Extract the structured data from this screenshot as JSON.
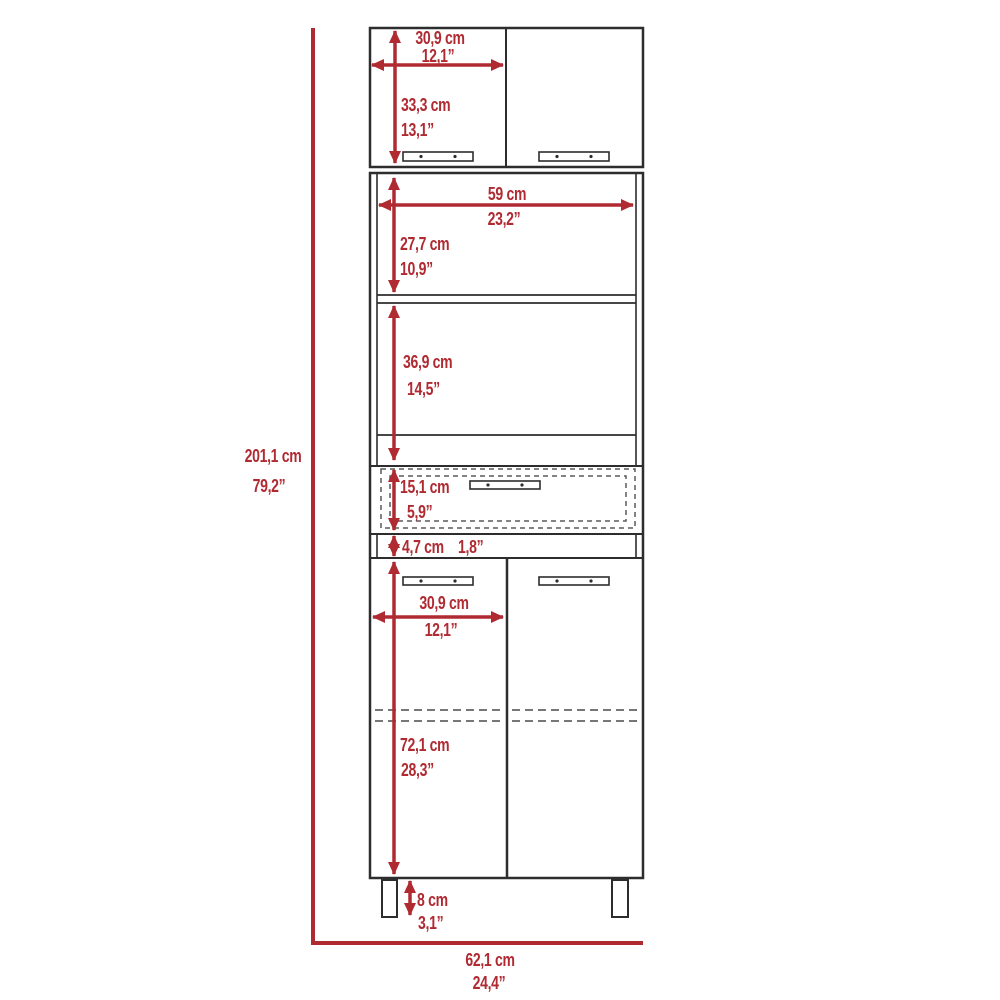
{
  "diagram": {
    "title": "pantry-cabinet-dimension-diagram",
    "colors": {
      "dimension_red": "#b02a32",
      "outline": "#2d2d2d",
      "background": "#ffffff"
    },
    "dims": {
      "overall_height": {
        "cm": "201,1 cm",
        "in": "79,2”"
      },
      "overall_width": {
        "cm": "62,1 cm",
        "in": "24,4”"
      },
      "top_door_width": {
        "cm": "30,9 cm",
        "in": "12,1”"
      },
      "top_door_height": {
        "cm": "33,3 cm",
        "in": "13,1”"
      },
      "open_width": {
        "cm": "59 cm",
        "in": "23,2”"
      },
      "open_top_height": {
        "cm": "27,7 cm",
        "in": "10,9”"
      },
      "open_bottom_height": {
        "cm": "36,9 cm",
        "in": "14,5”"
      },
      "drawer_height": {
        "cm": "15,1 cm",
        "in": "5,9”"
      },
      "divider_height": {
        "cm": "4,7 cm",
        "in": "1,8”"
      },
      "bottom_door_width": {
        "cm": "30,9 cm",
        "in": "12,1”"
      },
      "bottom_door_height": {
        "cm": "72,1 cm",
        "in": "28,3”"
      },
      "leg_height": {
        "cm": "8 cm",
        "in": "3,1”"
      }
    }
  }
}
